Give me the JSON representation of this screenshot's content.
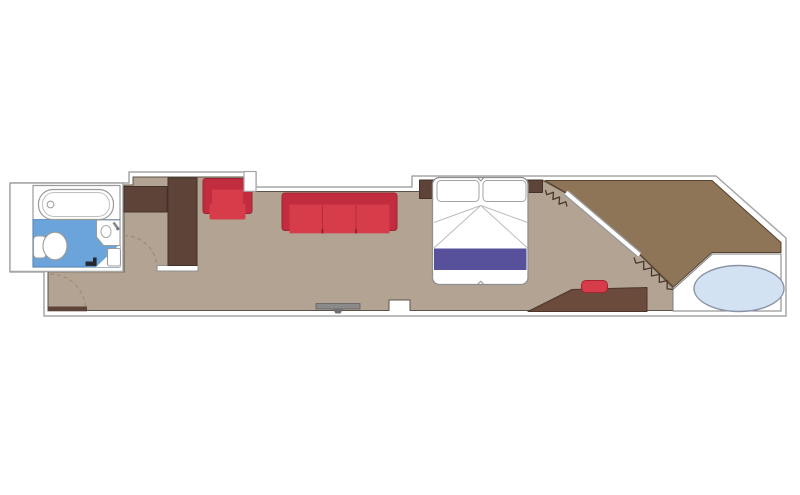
{
  "meta": {
    "title": "suite-floor-plan",
    "canvas": {
      "width": 800,
      "height": 495,
      "background": "#ffffff"
    }
  },
  "palette": {
    "wall_white": "#ffffff",
    "wall_stroke": "#a6a6a6",
    "floor_interior": "#b2a393",
    "floor_balcony": "#8f7557",
    "dark_wood": "#5e4438",
    "desk_wood": "#6b4b3c",
    "red_frame": "#c12d3e",
    "red_seat": "#d63c49",
    "bed_runner_purple": "#57519b",
    "bathroom_blue": "#6ba4da",
    "hot_tub_blue": "#d3e2f2",
    "tv_gray": "#8a8a8a",
    "door_swing_dash": "#a08b76",
    "curtain_zigzag": "#4a3729"
  },
  "floorplan": {
    "shapes": [
      {
        "name": "suite-outline",
        "type": "path",
        "d": "M129,172 L256,172 L256,187 L412,187 L412,176 L716,176 L786,238 L786,316 L44,316 L44,272 L10,272 L10,183 L129,183 Z",
        "fill": "#ffffff",
        "stroke": "#a6a6a6",
        "sw": 1.5
      },
      {
        "name": "floor-interior",
        "type": "polygon",
        "pts": "133,177 244,177 244,191.5 420,191.5 420,180.5 543,180.5 567.5,194 637.5,252 641,256 673,288 673,310.5 410,310.5 410,300 389,300 389,310.5 48,310.5 48,272 124,272 124,185 133,185",
        "fill": "#b2a393",
        "stroke": "#5d5247",
        "sw": 1
      },
      {
        "name": "floor-balcony",
        "type": "polygon",
        "pts": "545,180.5 712,180.5 781,242.5 781,252.5 712,252.5 673.5,287 641,255.5 637.5,251.5 567.5,193.5",
        "fill": "#8f7557",
        "stroke": "#55422e",
        "sw": 1
      },
      {
        "name": "balcony-deck-platform",
        "type": "polygon",
        "pts": "673,289.5 712.5,254 781,254 781,311 673,311",
        "fill": "#ffffff",
        "stroke": "#7e7e7e",
        "sw": 1
      },
      {
        "name": "hot-tub",
        "type": "ellipse",
        "cx": 739,
        "cy": 288.5,
        "rx": 45,
        "ry": 23,
        "fill": "#d3e2f2",
        "stroke": "#8a93a5",
        "sw": 1.4
      },
      {
        "name": "bathroom-box",
        "type": "rect",
        "x": 10,
        "y": 183,
        "w": 113,
        "h": 88.5,
        "fill": "#ffffff",
        "stroke": "#a6a6a6",
        "sw": 1.4
      },
      {
        "name": "bathroom-room",
        "type": "rect",
        "x": 33,
        "y": 185.5,
        "w": 87,
        "h": 81.5,
        "fill": "#ffffff",
        "stroke": "#9b9b9b",
        "sw": 1.2
      },
      {
        "name": "bathroom-floor",
        "type": "rect",
        "x": 33,
        "y": 219.5,
        "w": 87,
        "h": 47.5,
        "fill": "#6ba4da",
        "stroke": "#4d7fb5",
        "sw": 0.8
      },
      {
        "name": "bathroom-floor-corner",
        "type": "polygon",
        "pts": "96,267 120,244 120,267",
        "fill": "#ffffff"
      },
      {
        "name": "bathtub",
        "type": "rect",
        "x": 38.5,
        "y": 189.5,
        "w": 75,
        "h": 30,
        "rx": 14.5,
        "fill": "#ffffff",
        "stroke": "#9b9b9b",
        "sw": 1.2
      },
      {
        "name": "bathtub-inner",
        "type": "rect",
        "x": 42.5,
        "y": 192.5,
        "w": 67,
        "h": 24,
        "rx": 11.5,
        "fill": "none",
        "stroke": "#c0c0c0",
        "sw": 1
      },
      {
        "name": "bathtub-drain",
        "type": "circle",
        "cx": 50.5,
        "cy": 204.5,
        "r": 3.4,
        "fill": "#ffffff",
        "stroke": "#9b9b9b",
        "sw": 1
      },
      {
        "name": "toilet-tank",
        "type": "rect",
        "x": 33.5,
        "y": 236,
        "w": 12.5,
        "h": 22,
        "rx": 3.5,
        "fill": "#ffffff",
        "stroke": "#9b9b9b",
        "sw": 1.1
      },
      {
        "name": "toilet-bowl",
        "type": "ellipse",
        "cx": 55,
        "cy": 246,
        "rx": 12,
        "ry": 13.8,
        "fill": "#ffffff",
        "stroke": "#9b9b9b",
        "sw": 1.1
      },
      {
        "name": "sink-counter",
        "type": "path",
        "d": "M96.5,220 L120,220 L120,245.5 L103.5,245.5 L96.5,237 Z",
        "fill": "#ffffff",
        "stroke": "#9b9b9b",
        "sw": 1.1
      },
      {
        "name": "sink-basin",
        "type": "ellipse",
        "cx": 106,
        "cy": 231.5,
        "rx": 5,
        "ry": 6,
        "fill": "#ffffff",
        "stroke": "#ababab",
        "sw": 1
      },
      {
        "name": "sink-faucet",
        "type": "line",
        "x1": 113.5,
        "y1": 222.5,
        "x2": 118,
        "y2": 228.5,
        "stroke": "#8a8a8a",
        "sw": 2.6
      },
      {
        "name": "sink-faucet-knob",
        "type": "circle",
        "cx": 117.8,
        "cy": 228.8,
        "r": 1.6,
        "fill": "#777777"
      },
      {
        "name": "bathroom-shelf",
        "type": "rect",
        "x": 107.5,
        "y": 248.5,
        "w": 13,
        "h": 17.5,
        "rx": 2,
        "fill": "#ffffff",
        "stroke": "#9b9b9b",
        "sw": 1.1
      },
      {
        "name": "bathroom-door-stop",
        "type": "rect",
        "x": 85.5,
        "y": 261.5,
        "w": 11,
        "h": 4.4,
        "fill": "#242831"
      },
      {
        "name": "bathroom-door-stop-2",
        "type": "rect",
        "x": 93,
        "y": 257.5,
        "w": 3.6,
        "h": 8.4,
        "fill": "#242831"
      },
      {
        "name": "closet-wall",
        "type": "rect",
        "x": 157,
        "y": 265.5,
        "w": 41,
        "h": 5.5,
        "fill": "#ffffff",
        "stroke": "#8f8f8f",
        "sw": 1
      },
      {
        "name": "closet-cabinet",
        "type": "rect",
        "x": 124,
        "y": 186.5,
        "w": 43,
        "h": 25.5,
        "fill": "#5e4438",
        "stroke": "#44312a",
        "sw": 1
      },
      {
        "name": "wardrobe-column",
        "type": "rect",
        "x": 168,
        "y": 178,
        "w": 29,
        "h": 87.5,
        "fill": "#5e4438",
        "stroke": "#44312a",
        "sw": 1
      },
      {
        "name": "closet-door-swing",
        "type": "path",
        "d": "M124,235.5 A33,33 0 0 1 157,268.5",
        "fill": "none",
        "stroke": "#a08b76",
        "sw": 1.2,
        "dash": "4 3"
      },
      {
        "name": "entry-door-swing",
        "type": "path",
        "d": "M50,274 A35.5,35.5 0 0 1 85.5,309.5",
        "fill": "none",
        "stroke": "#a08b76",
        "sw": 1.2,
        "dash": "4 3"
      },
      {
        "name": "entry-door",
        "type": "rect",
        "x": 47.5,
        "y": 306.5,
        "w": 39.5,
        "h": 4.8,
        "fill": "#5e4438"
      },
      {
        "name": "armchair-frame",
        "type": "rect",
        "x": 203,
        "y": 178.5,
        "w": 49,
        "h": 35,
        "rx": 2.5,
        "fill": "#c12d3e",
        "stroke": "#9e2433",
        "sw": 1
      },
      {
        "name": "armchair-seat",
        "type": "rect",
        "x": 212,
        "y": 189.5,
        "w": 31,
        "h": 24,
        "fill": "#d63c49"
      },
      {
        "name": "armchair-cushion",
        "type": "rect",
        "x": 209.5,
        "y": 203.5,
        "w": 36,
        "h": 16,
        "rx": 2,
        "fill": "#d63c49"
      },
      {
        "name": "wall-step",
        "type": "rect",
        "x": 244,
        "y": 171.5,
        "w": 12,
        "h": 19.8,
        "fill": "#ffffff",
        "stroke": "#a6a6a6",
        "sw": 1.2
      },
      {
        "name": "sofa-frame",
        "type": "rect",
        "x": 282,
        "y": 193,
        "w": 115,
        "h": 37.5,
        "rx": 3,
        "fill": "#c12d3e",
        "stroke": "#9e2433",
        "sw": 1
      },
      {
        "name": "sofa-seats",
        "type": "rect",
        "x": 289.5,
        "y": 204.5,
        "w": 100,
        "h": 28.8,
        "fill": "#d63c49"
      },
      {
        "name": "sofa-seat-divider-1",
        "type": "line",
        "x1": 322.5,
        "y1": 205,
        "x2": 322.5,
        "y2": 233,
        "stroke": "#b82c3a",
        "sw": 1
      },
      {
        "name": "sofa-seat-divider-2",
        "type": "line",
        "x1": 356,
        "y1": 205,
        "x2": 356,
        "y2": 233,
        "stroke": "#b82c3a",
        "sw": 1
      },
      {
        "name": "sofa-notch-1",
        "type": "line",
        "x1": 322.5,
        "y1": 229,
        "x2": 322.5,
        "y2": 233.5,
        "stroke": "#8d2230",
        "sw": 1.8
      },
      {
        "name": "sofa-notch-2",
        "type": "line",
        "x1": 356,
        "y1": 229,
        "x2": 356,
        "y2": 233.5,
        "stroke": "#8d2230",
        "sw": 1.8
      },
      {
        "name": "tv-console",
        "type": "rect",
        "x": 316,
        "y": 303.5,
        "w": 44,
        "h": 5.5,
        "fill": "#8a8a8a",
        "stroke": "#5f5f5f",
        "sw": 0.8
      },
      {
        "name": "tv-stand",
        "type": "polygon",
        "pts": "333,309 343,309 340.5,313.5 335.5,313.5",
        "fill": "#6f6f6f"
      },
      {
        "name": "nightstand-left",
        "type": "rect",
        "x": 419.5,
        "y": 180,
        "w": 16.5,
        "h": 18.5,
        "fill": "#5e4438",
        "stroke": "#44312a",
        "sw": 1
      },
      {
        "name": "nightstand-right",
        "type": "rect",
        "x": 527,
        "y": 180,
        "w": 15.5,
        "h": 12.5,
        "fill": "#5e4438",
        "stroke": "#44312a",
        "sw": 1
      },
      {
        "name": "bed",
        "type": "rect",
        "x": 432.5,
        "y": 177.5,
        "w": 95.5,
        "h": 107,
        "rx": 7,
        "fill": "#ffffff",
        "stroke": "#8f8f8f",
        "sw": 1.3
      },
      {
        "name": "pillow-left",
        "type": "rect",
        "x": 437,
        "y": 180.5,
        "w": 42,
        "h": 21,
        "rx": 4,
        "fill": "#ffffff",
        "stroke": "#a3a3a3",
        "sw": 1
      },
      {
        "name": "pillow-right",
        "type": "rect",
        "x": 483,
        "y": 180.5,
        "w": 43,
        "h": 21,
        "rx": 4,
        "fill": "#ffffff",
        "stroke": "#a3a3a3",
        "sw": 1
      },
      {
        "name": "sheet-fold-1",
        "type": "line",
        "x1": 480.8,
        "y1": 205.5,
        "x2": 434,
        "y2": 222.5,
        "stroke": "#bcbcbc",
        "sw": 1
      },
      {
        "name": "sheet-fold-2",
        "type": "line",
        "x1": 480.8,
        "y1": 205.5,
        "x2": 434,
        "y2": 248,
        "stroke": "#bcbcbc",
        "sw": 1
      },
      {
        "name": "sheet-fold-3",
        "type": "line",
        "x1": 480.8,
        "y1": 205.5,
        "x2": 527.5,
        "y2": 222.5,
        "stroke": "#bcbcbc",
        "sw": 1
      },
      {
        "name": "sheet-fold-4",
        "type": "line",
        "x1": 480.8,
        "y1": 205.5,
        "x2": 527.5,
        "y2": 248,
        "stroke": "#bcbcbc",
        "sw": 1
      },
      {
        "name": "bed-runner",
        "type": "rect",
        "x": 434,
        "y": 248.5,
        "w": 92.5,
        "h": 21.5,
        "fill": "#57519b"
      },
      {
        "name": "bed-notch-top",
        "type": "path",
        "d": "M477.5,177.5 L480.8,181 L484,177.5",
        "fill": "none",
        "stroke": "#8f8f8f",
        "sw": 1
      },
      {
        "name": "bed-notch-bottom",
        "type": "path",
        "d": "M477.5,284.5 L480.8,281.2 L484,284.5",
        "fill": "none",
        "stroke": "#8f8f8f",
        "sw": 1
      },
      {
        "name": "vanity-desk",
        "type": "polygon",
        "pts": "528,311.5 572,289.5 647,287.5 647,311.5",
        "fill": "#6b4b3c",
        "stroke": "#4d352b",
        "sw": 1
      },
      {
        "name": "stool",
        "type": "rect",
        "x": 581.5,
        "y": 280.5,
        "w": 26,
        "h": 12,
        "rx": 4.5,
        "fill": "#d63c49",
        "stroke": "#a8242f",
        "sw": 1
      },
      {
        "name": "curtain-upper",
        "type": "zigzag",
        "x1": 545.5,
        "y1": 190,
        "x2": 567,
        "y2": 206.5,
        "n": 7,
        "amp": 3,
        "stroke": "#4a3729",
        "sw": 1.3
      },
      {
        "name": "curtain-lower",
        "type": "zigzag",
        "x1": 634,
        "y1": 257.5,
        "x2": 673,
        "y2": 289.5,
        "n": 10,
        "amp": 3.2,
        "stroke": "#4a3729",
        "sw": 1.3
      },
      {
        "name": "glass-door-frame",
        "type": "line",
        "x1": 566,
        "y1": 192.5,
        "x2": 639.5,
        "y2": 255,
        "stroke": "#9a9a9a",
        "sw": 6.5
      },
      {
        "name": "glass-door-pane",
        "type": "line",
        "x1": 566,
        "y1": 192.5,
        "x2": 639.5,
        "y2": 255,
        "stroke": "#ffffff",
        "sw": 3.8
      }
    ]
  }
}
